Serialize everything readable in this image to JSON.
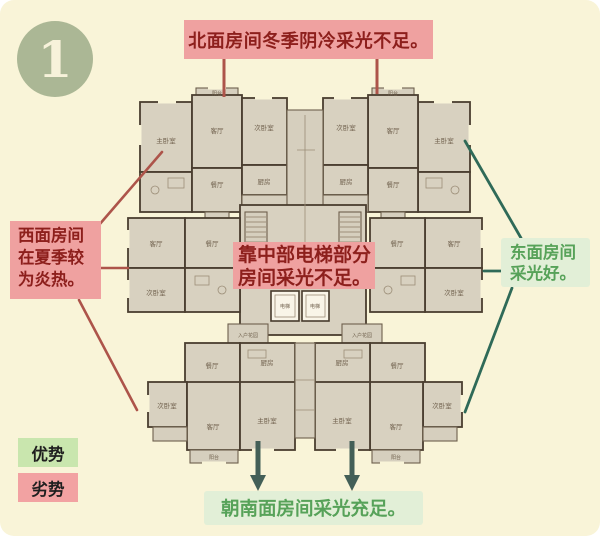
{
  "badge": {
    "number": "1"
  },
  "callouts": {
    "north": {
      "text": "北面房间冬季阴冷采光不足。"
    },
    "west": {
      "line1": "西面房间",
      "line2": "在夏季较",
      "line3": "为炎热。"
    },
    "center": {
      "line1": "靠中部电梯部分",
      "line2": "房间采光不足。"
    },
    "east": {
      "line1": "东面房间",
      "line2": "采光好。"
    },
    "south": {
      "text": "朝南面房间采光充足。"
    }
  },
  "legend": {
    "advantage": "优势",
    "disadvantage": "劣势"
  },
  "floorplan": {
    "labels": {
      "master": "主卧室",
      "living": "客厅",
      "second": "次卧室",
      "dining": "餐厅",
      "kitchen": "厨房",
      "balcony": "阳台",
      "elevator": "电梯",
      "entry": "入户花园"
    }
  },
  "colors": {
    "background": "#f9f4d8",
    "negative_bg": "#efa1a0",
    "negative_text": "#8d1f1c",
    "positive_bg": "#e2efd7",
    "positive_text": "#57a259",
    "advantage_bg": "#c9e6ae",
    "disadvantage_bg": "#f2a2a2",
    "connector_red": "#ad544a",
    "connector_green": "#2f6a58",
    "plan_wall": "#4a3e2f",
    "plan_fill": "#d8d1c0",
    "badge_bg": "#abb795"
  }
}
